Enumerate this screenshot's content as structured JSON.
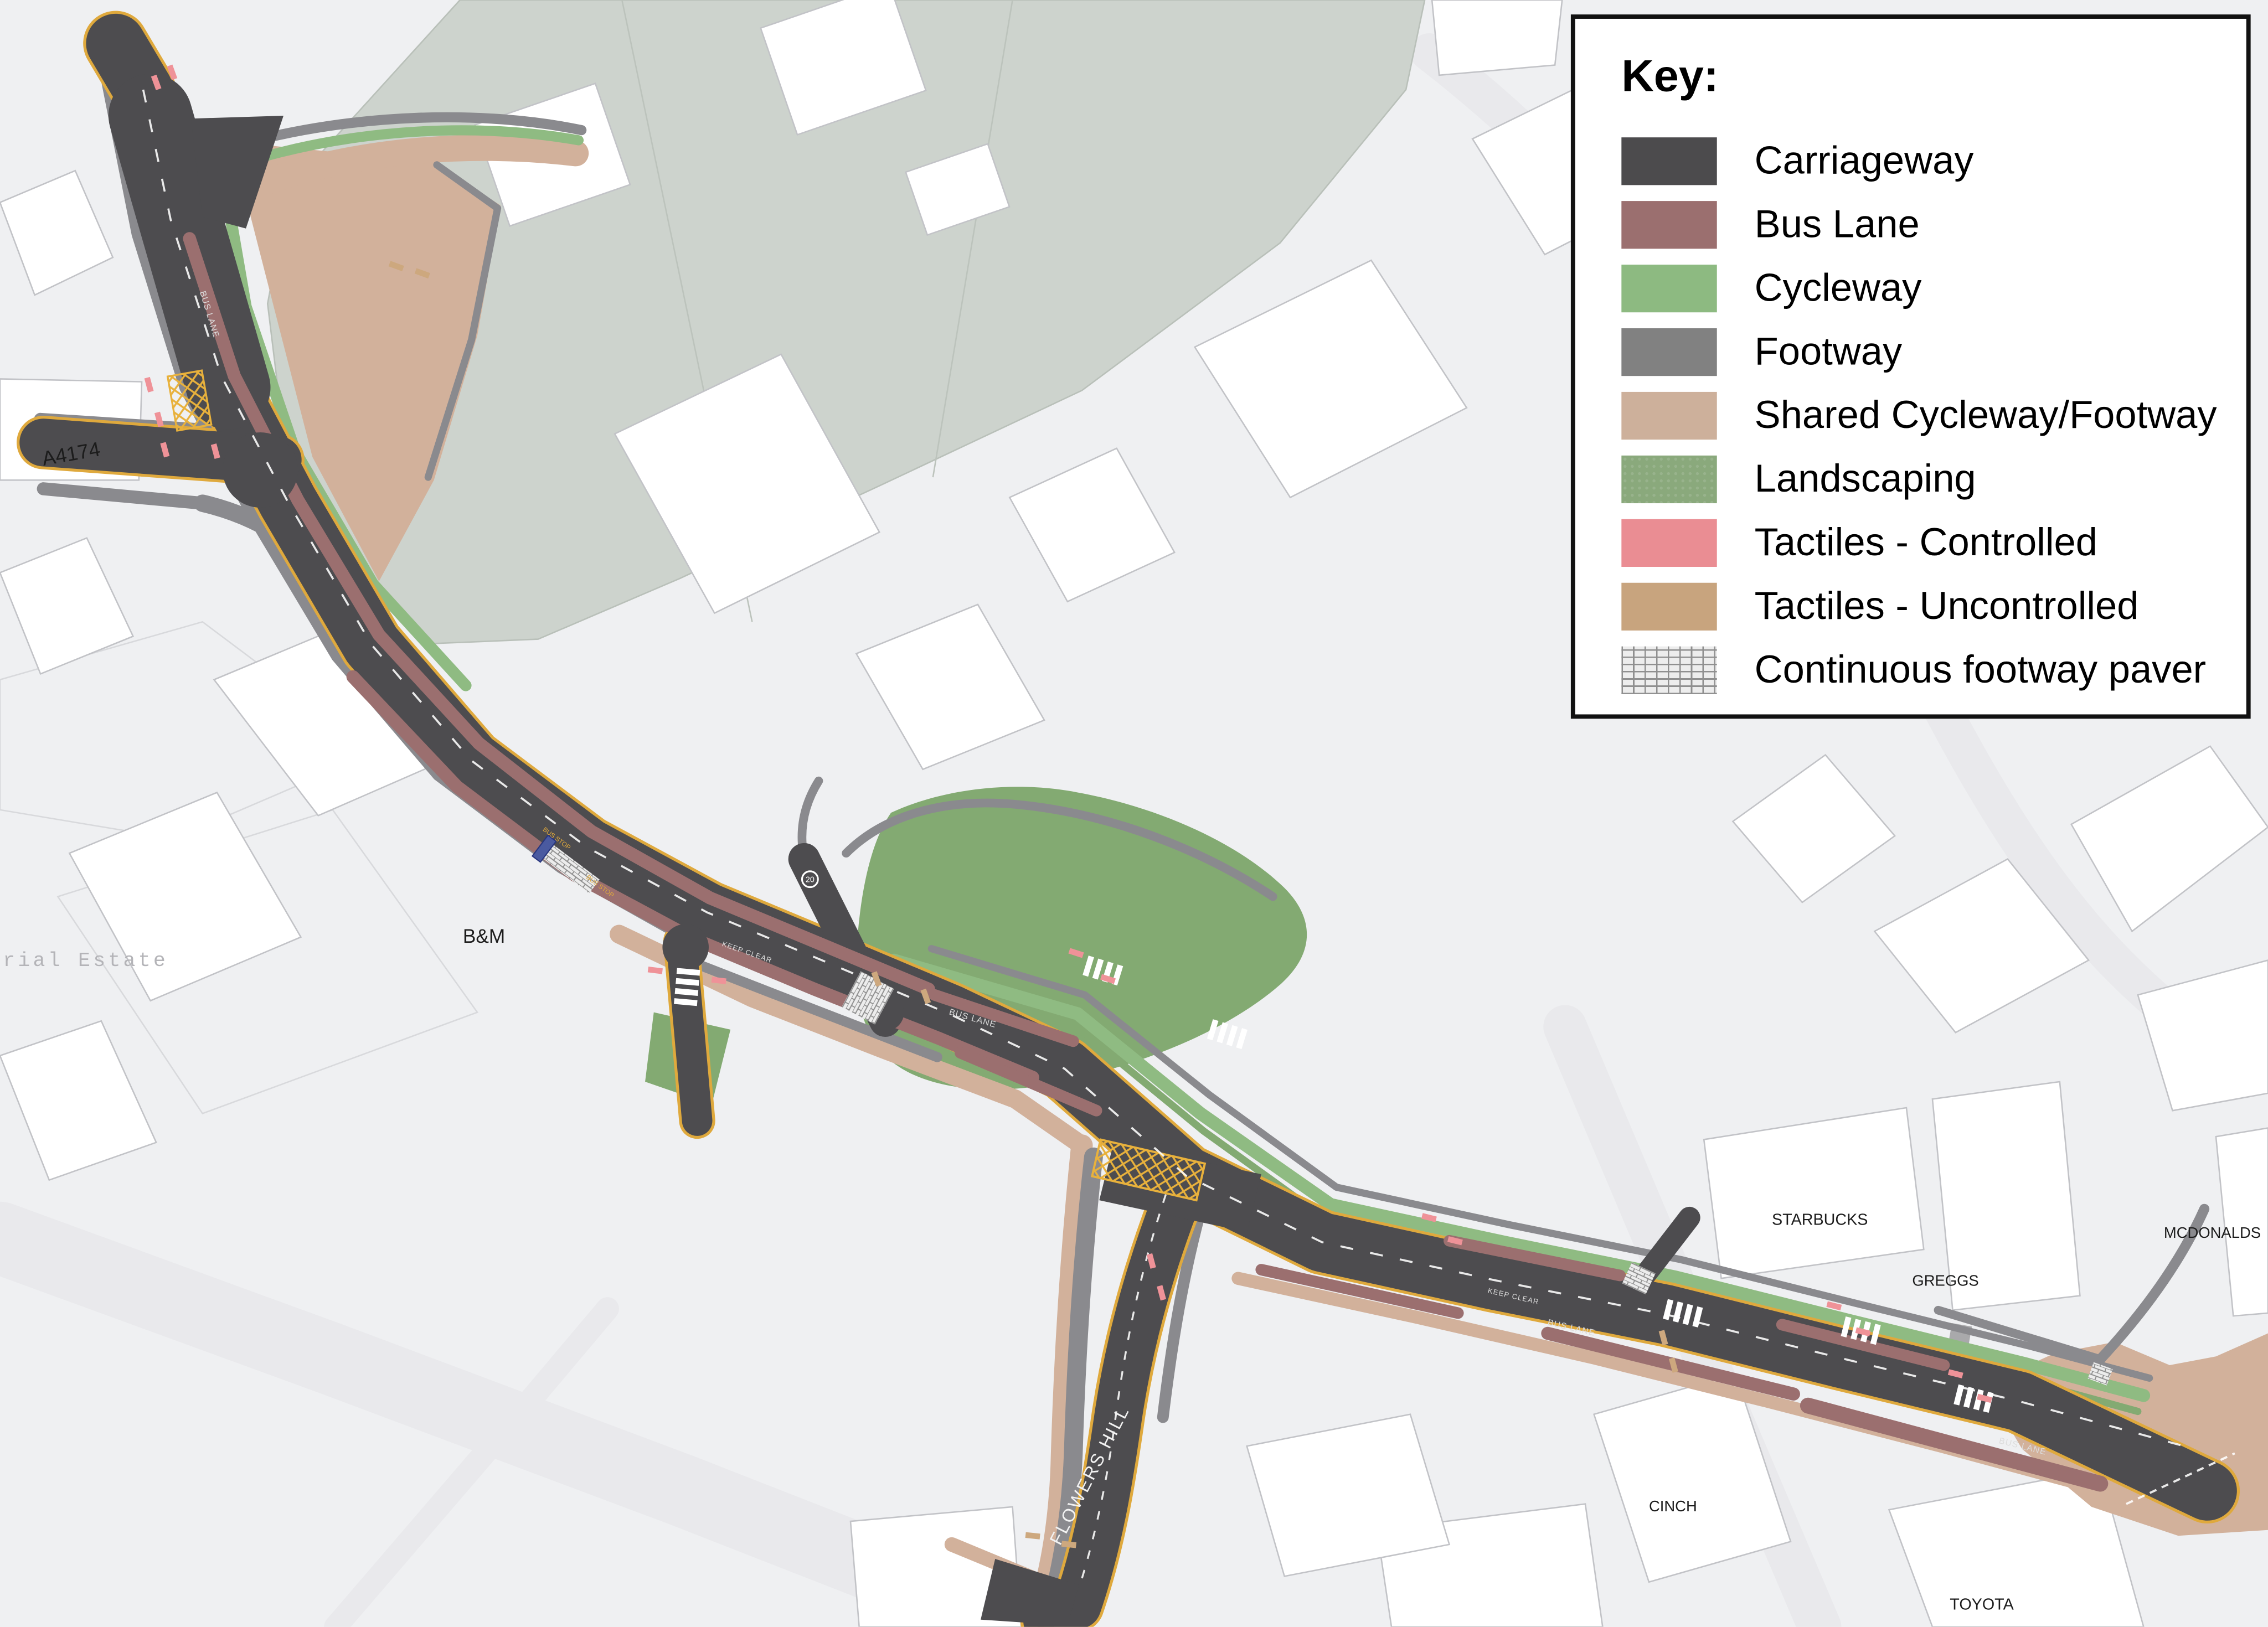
{
  "legend": {
    "title": "Key:",
    "items": [
      {
        "label": "Carriageway",
        "color": "#4c4b4d"
      },
      {
        "label": "Bus Lane",
        "color": "#9b6f6f"
      },
      {
        "label": "Cycleway",
        "color": "#8dba81"
      },
      {
        "label": "Footway",
        "color": "#818181"
      },
      {
        "label": "Shared Cycleway/Footway",
        "color": "#cdb09b"
      },
      {
        "label": "Landscaping",
        "color": "#8aa97c"
      },
      {
        "label": "Tactiles - Controlled",
        "color": "#ea8d93"
      },
      {
        "label": "Tactiles - Uncontrolled",
        "color": "#c8a47e"
      },
      {
        "label": "Continuous footway paver",
        "color": "#ededed",
        "pattern": "brick"
      }
    ]
  },
  "map": {
    "place_labels": {
      "a4174": "A4174",
      "industrial_estate_partial": "rial Estate",
      "bm": "B&M",
      "starbucks": "STARBUCKS",
      "greggs": "GREGGS",
      "mcdonalds": "MCDONALDS",
      "cinch": "CINCH",
      "toyota": "TOYOTA"
    },
    "road_markings": {
      "flowers_hill": "FLOWERS HILL",
      "bus_lane": "BUS LANE",
      "bus_stop": "BUS STOP",
      "keep_clear": "KEEP CLEAR",
      "speed_limit": "20"
    },
    "colors": {
      "background": "#eff0f2",
      "building_fill": "#ffffff",
      "building_stroke": "#c2c3c7",
      "field": "#cdd3cd",
      "carriageway": "#4d4c4f",
      "bus_lane": "#9b6f6f",
      "cycleway": "#8fbb82",
      "footway": "#8a8a8e",
      "shared_path": "#d2b19b",
      "landscaping": "#83aa72",
      "tactile_controlled": "#ef9298",
      "tactile_uncontrolled": "#cda87e",
      "edge_line_yellow": "#dfa93d"
    }
  }
}
